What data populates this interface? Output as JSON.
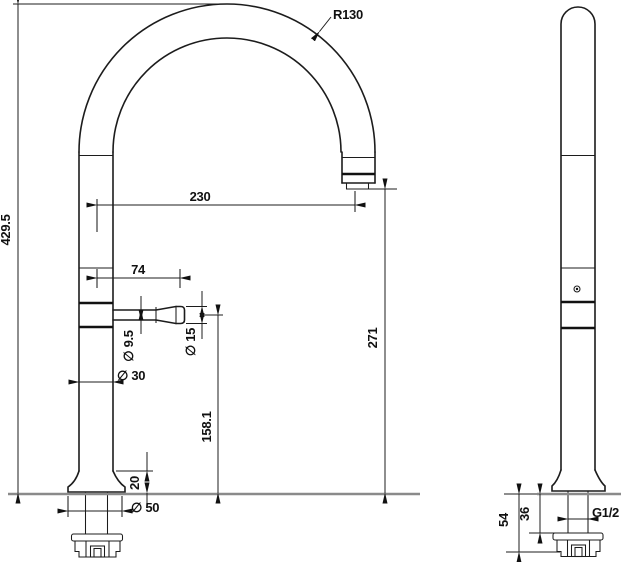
{
  "drawing": {
    "type": "technical-dimension-drawing",
    "subject": "gooseneck faucet, front and side orthographic views",
    "colors": {
      "line": "#1c1c1c",
      "counter_line": "#8a8a8a",
      "background": "#ffffff"
    },
    "front": {
      "dims": {
        "arc_radius": "R130",
        "total_height": "429.5",
        "spout_reach": "230",
        "handle_length": "74",
        "handle_stem_diameter": "∅ 9.5",
        "handle_knob_diameter": "∅ 15",
        "body_diameter": "∅ 30",
        "spout_outlet_height": "271",
        "handle_axis_height": "158.1",
        "base_height": "20",
        "base_diameter": "∅ 50"
      }
    },
    "side": {
      "dims": {
        "below_counter_depth": "54",
        "shank_depth": "36",
        "thread_size": "G1/2"
      }
    }
  }
}
